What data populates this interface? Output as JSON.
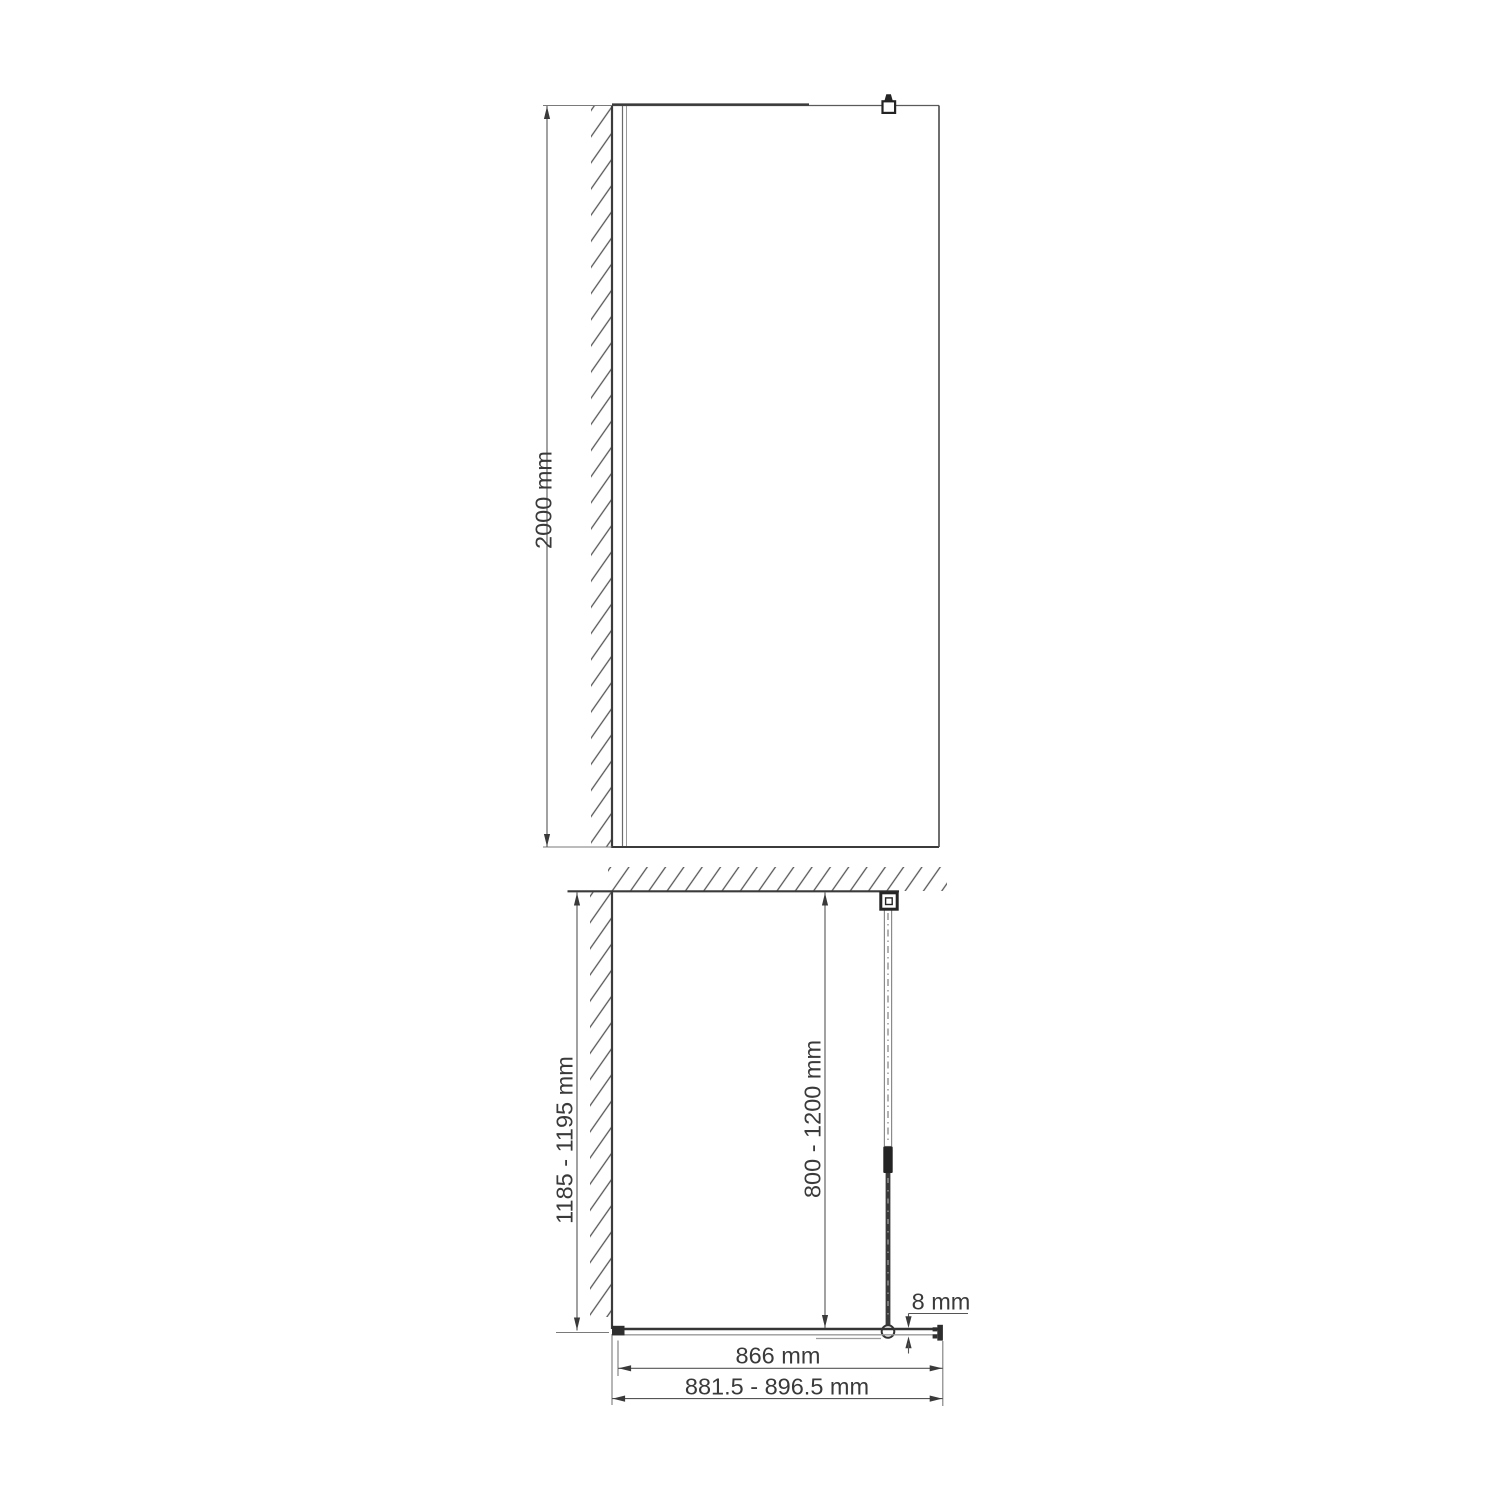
{
  "meta": {
    "title": "Walk-in shower glass screen installation drawing",
    "background": "#ffffff"
  },
  "colors": {
    "object_line": "#3b3b3b",
    "dimension_line": "#555555",
    "extension_line": "#7a7a7a",
    "light_line": "#9a9a9a",
    "hatch_line": "#565656",
    "dark_fill": "#282828",
    "text": "#3a3a3a"
  },
  "front_view": {
    "name": "front-elevation",
    "dimensions": {
      "height": "2000 mm"
    },
    "parts": {
      "wall": "side-wall-hatched",
      "wall_profile": "wall-mounting-profile",
      "glass": "glass-panel",
      "clamp": "support-bar-glass-clamp"
    }
  },
  "plan_view": {
    "name": "top-plan-view",
    "dimensions": {
      "wall_to_glass_depth": "1185 - 1195 mm",
      "support_bar_length": "800 - 1200 mm",
      "glass_thickness": "8 mm",
      "glass_width": "866 mm",
      "overall_width": "881.5 - 896.5 mm"
    },
    "parts": {
      "back_wall": "back-wall-hatched",
      "side_wall": "side-wall-hatched",
      "support_bar": "telescopic-support-bar",
      "wall_bracket": "support-bar-wall-bracket",
      "glass_connector": "support-bar-glass-connector",
      "wall_profile": "wall-mounting-profile",
      "end_cap": "glass-end-profile"
    }
  }
}
